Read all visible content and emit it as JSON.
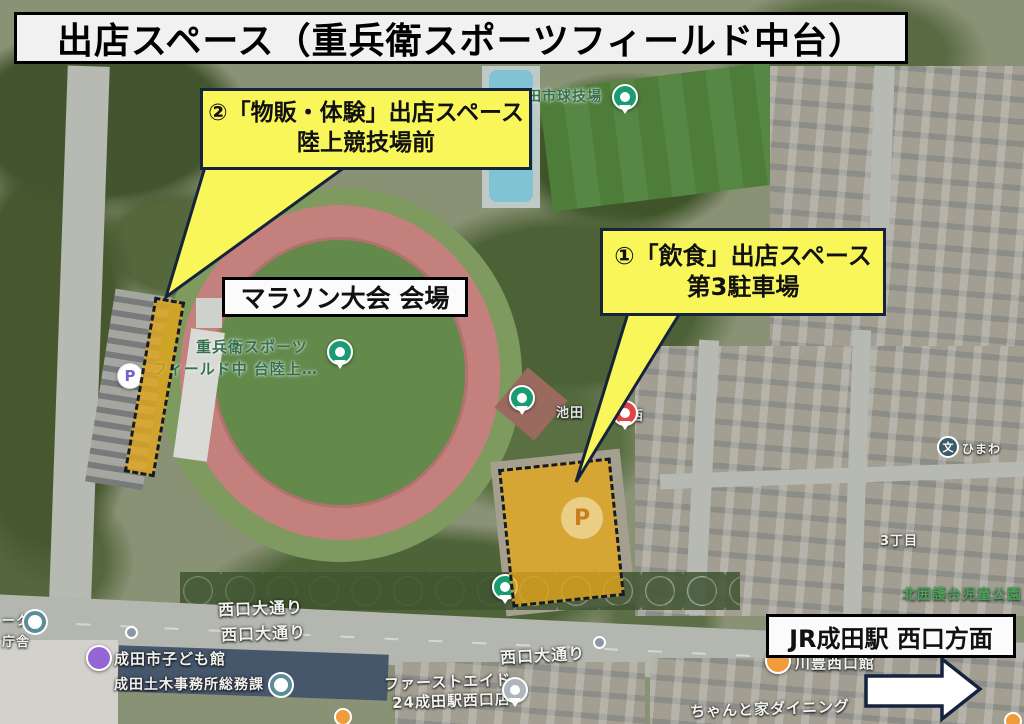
{
  "title": "出店スペース（重兵衛スポーツフィールド中台）",
  "callouts": {
    "goods": {
      "line1": "②「物販・体験」出店スペース",
      "line2": "陸上競技場前"
    },
    "food": {
      "line1": "①「飲食」出店スペース",
      "line2": "第3駐車場"
    }
  },
  "labels": {
    "marathon_venue": "マラソン大会 会場",
    "station_direction": "JR成田駅 西口方面"
  },
  "map_labels": {
    "ballpark": "田市球技場",
    "sports_field_line1": "重兵衛スポーツ",
    "sports_field_line2": "フィールド中 台陸上…",
    "ikeda": "池田",
    "ikeda_west": "西",
    "chome": "3丁目",
    "children_park": "北囲護台児童公園",
    "himawari": "ひまわ",
    "odori_1": "西口大通り",
    "odori_2": "西口大通り",
    "odori_3": "西口大通り",
    "kodomokan": "成田市子ども館",
    "doboku": "成田土木事務所総務課",
    "firstaid_line1": "ファーストエイド",
    "firstaid_line2": "24成田駅西口店",
    "kawatoyo": "川豊西口館",
    "dining": "ちゃんと家ダイニング",
    "fragment_park": "ーク",
    "fragment_chosha": "庁舎"
  },
  "icons": {
    "parking_glyph": "P",
    "school_glyph": "文"
  },
  "colors": {
    "callout_yellow": "#f8f659",
    "zone_fill": "#e4a71a",
    "outline_navy": "#16233d",
    "pin_green": "#1a9c72",
    "pin_red": "#e04545",
    "pin_purple": "#9565d6",
    "pin_orange": "#f09b3c",
    "track_red": "#c3807d"
  }
}
